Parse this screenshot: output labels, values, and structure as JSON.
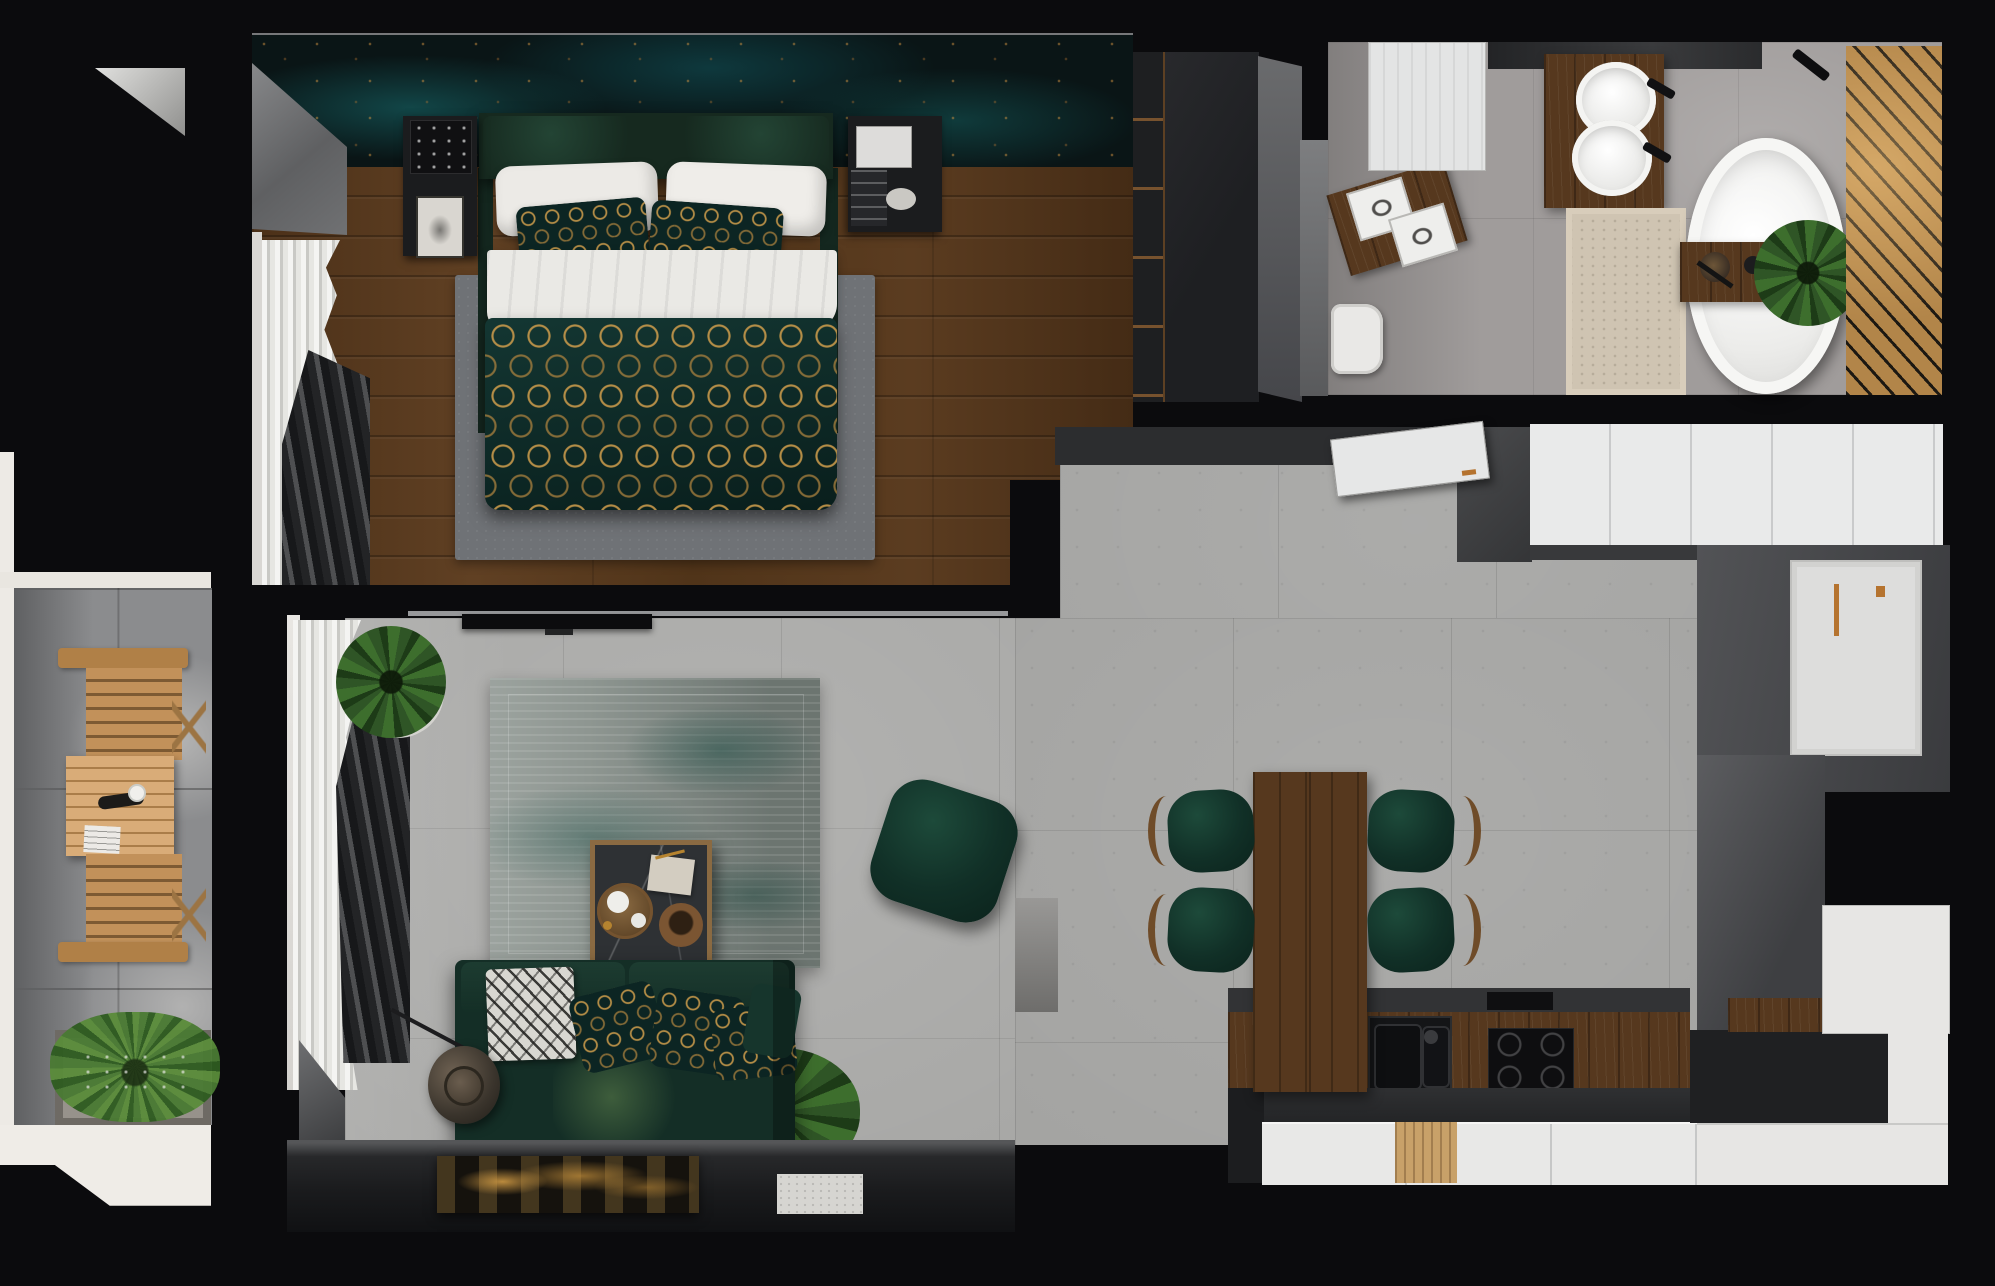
{
  "scene": {
    "title": "Apartment floor plan - photorealistic top-down render",
    "style": "dark green and walnut interior, black walls"
  },
  "palette": {
    "wall_black": "#0b0b0d",
    "bedroom_wood": "#54381e",
    "wallpaper_teal": "#0a1516",
    "wallpaper_gold": "#c69437",
    "bed_green": "#1b3429",
    "duvet_teal": "#0d2a27",
    "duvet_gold": "#c69a4a",
    "concrete_floor": "#a2a2a0",
    "bath_tile": "#a09c9b",
    "beige_rug": "#cfc4b2",
    "bath_deck_wood": "#b28549",
    "kitchen_walnut": "#56381e",
    "cabinet_white": "#e9eaea",
    "copper_handle": "#b5732f",
    "sofa_green": "#142e26",
    "balcony_wood": "#c2915a",
    "plant_green": "#3a6b2c"
  },
  "rooms": {
    "bedroom": {
      "label": "Bedroom",
      "items": [
        "double bed",
        "art-deco patterned duvet",
        "white pillows",
        "two nightstands",
        "wardrobe",
        "gray area rug",
        "curtains",
        "teal-gold marble headboard wall"
      ]
    },
    "bathroom": {
      "label": "Bathroom",
      "items": [
        "freestanding oval bathtub",
        "bath caddy tray with plant",
        "round double-sink vanity",
        "square-sink vanity",
        "toilet",
        "tall white cabinet",
        "beige rug",
        "diagonal wood slat deck"
      ]
    },
    "kitchen": {
      "label": "Kitchen & Dining",
      "items": [
        "L-shaped walnut counter",
        "black double sink",
        "induction hob",
        "white upper cabinets",
        "open cabinet door",
        "walnut dining table",
        "four green chairs"
      ]
    },
    "living": {
      "label": "Living Room",
      "items": [
        "dark green sofa",
        "patterned throw pillows",
        "marble coffee table",
        "green pouf",
        "distressed teal rug",
        "wall TV",
        "floor lamp",
        "potted plants",
        "leaning gold artwork"
      ]
    },
    "balcony": {
      "label": "Balcony",
      "items": [
        "two folding wooden chairs",
        "slatted wooden table",
        "grass planter"
      ]
    },
    "hall": {
      "label": "Entry Hall",
      "items": [
        "white entrance door with copper handle",
        "tall gray cabinets"
      ]
    }
  }
}
